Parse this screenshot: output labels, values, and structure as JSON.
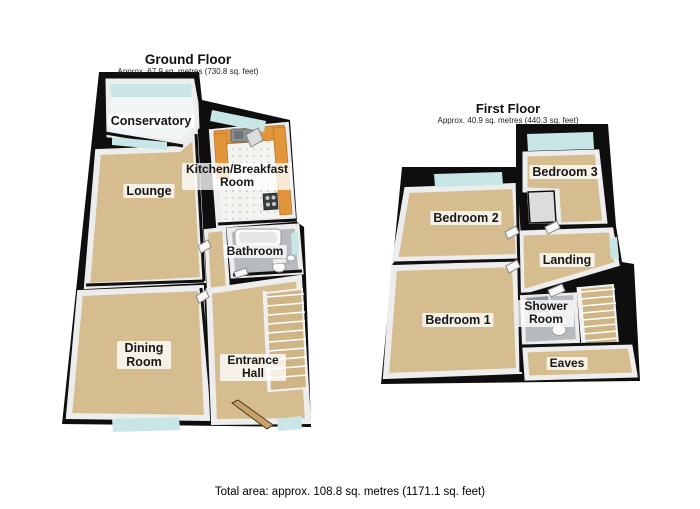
{
  "ground_floor": {
    "title": "Ground Floor",
    "subtitle": "Approx. 67.9 sq. metres (730.8 sq. feet)",
    "rooms": {
      "conservatory": "Conservatory",
      "lounge": "Lounge",
      "kitchen": "Kitchen/Breakfast Room",
      "bathroom": "Bathroom",
      "dining": "Dining Room",
      "entrance": "Entrance Hall"
    }
  },
  "first_floor": {
    "title": "First Floor",
    "subtitle": "Approx. 40.9 sq. metres (440.3 sq. feet)",
    "rooms": {
      "bedroom2": "Bedroom 2",
      "bedroom3": "Bedroom 3",
      "landing": "Landing",
      "bedroom1": "Bedroom 1",
      "shower": "Shower Room",
      "eaves": "Eaves"
    }
  },
  "footer": {
    "total_area": "Total area: approx. 108.8 sq. metres (1171.1 sq. feet)"
  },
  "colors": {
    "wall": "#0e0e0e",
    "carpet": "#d6bd8f",
    "stair": "#cfb485",
    "tile_gray": "#b7bbc0",
    "kitchen_floor": "#f3f3ef",
    "glass": "#c9e6e6",
    "counter": "#e2953b",
    "wood_door": "#c9a267",
    "inner_wall": "#ededed",
    "conservatory_floor": "#f3f6f6"
  }
}
